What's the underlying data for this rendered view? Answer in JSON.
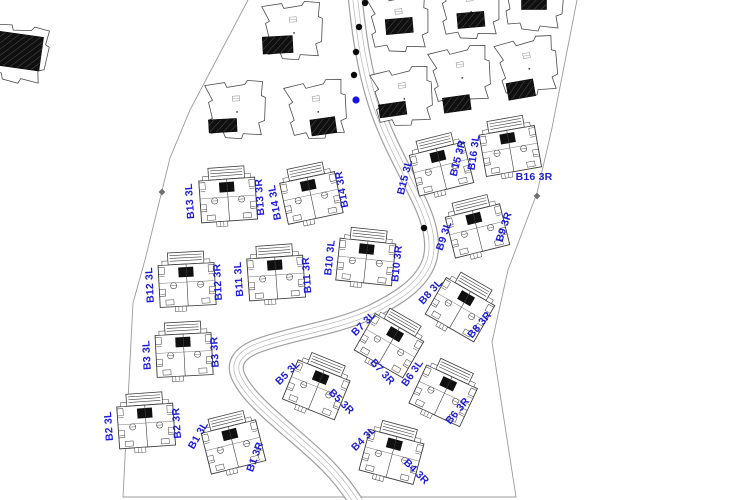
{
  "plan": {
    "title": "residential-site-plan",
    "canvas": {
      "width": 750,
      "height": 500
    },
    "colors": {
      "background": "#ffffff",
      "label_blue": "#1c1cd8",
      "line_dark": "#3d3d3d",
      "line_mid": "#6a6a6a",
      "boundary": "#9a9a9a",
      "road_outer": "#a0a0a0",
      "road_inner": "#b5b5b5",
      "black_fill": "#101010",
      "tree_dot": "#0a0a0a",
      "blue_dot": "#1414e6"
    },
    "boundary": {
      "points": [
        [
          248,
          0
        ],
        [
          190,
          110
        ],
        [
          170,
          158
        ],
        [
          145,
          260
        ],
        [
          133,
          303
        ],
        [
          123,
          497
        ],
        [
          516,
          497
        ],
        [
          492,
          342
        ],
        [
          508,
          270
        ],
        [
          537,
          193
        ],
        [
          552,
          128
        ],
        [
          577,
          0
        ]
      ],
      "markers": [
        [
          162,
          192
        ],
        [
          537,
          196
        ],
        [
          443,
          285
        ]
      ]
    },
    "road": {
      "path": "M 355,-4 C 359,35 364,68 374,100 C 385,136 402,165 417,196 C 428,218 436,242 429,262 C 421,284 399,298 373,311 C 337,328 297,332 263,344 C 241,351 231,362 239,378 C 248,396 267,412 290,432 C 313,452 336,470 356,502",
      "tree_dots": [
        [
          365,
          3
        ],
        [
          359,
          27
        ],
        [
          356,
          52
        ],
        [
          354,
          75
        ],
        [
          424,
          228
        ]
      ],
      "blue_dot": [
        356,
        100
      ]
    },
    "villas": [
      {
        "cx": 18,
        "cy": 54,
        "rot": 8,
        "rect": {
          "dx": 0,
          "dy": -3,
          "w": 46,
          "h": 34
        }
      },
      {
        "cx": 293,
        "cy": 31,
        "rot": -3,
        "rect": {
          "dx": -16,
          "dy": 13,
          "w": 30,
          "h": 17
        }
      },
      {
        "cx": 236,
        "cy": 110,
        "rot": -3,
        "rect": {
          "dx": -14,
          "dy": 15,
          "w": 28,
          "h": 13
        }
      },
      {
        "cx": 317,
        "cy": 110,
        "rot": -8,
        "rect": {
          "dx": 4,
          "dy": 17,
          "w": 25,
          "h": 16
        }
      },
      {
        "cx": 399,
        "cy": 23,
        "rot": -5,
        "rect": {
          "dx": 0,
          "dy": 3,
          "w": 27,
          "h": 15
        }
      },
      {
        "cx": 403,
        "cy": 97,
        "rot": -8,
        "rect": {
          "dx": -12,
          "dy": 11,
          "w": 27,
          "h": 13
        }
      },
      {
        "cx": 470,
        "cy": 10,
        "rot": -5,
        "rect": {
          "dx": 0,
          "dy": 10,
          "w": 27,
          "h": 15
        }
      },
      {
        "cx": 534,
        "cy": 2,
        "rot": 0,
        "rect": {
          "dx": 0,
          "dy": 1,
          "w": 25,
          "h": 13
        }
      },
      {
        "cx": 461,
        "cy": 76,
        "rot": -8,
        "rect": {
          "dx": -8,
          "dy": 27,
          "w": 27,
          "h": 15
        }
      },
      {
        "cx": 528,
        "cy": 67,
        "rot": -10,
        "rect": {
          "dx": -11,
          "dy": 21,
          "w": 27,
          "h": 17
        }
      }
    ],
    "duplexes": [
      {
        "id": "B13",
        "cx": 228,
        "cy": 198,
        "rot": -4,
        "left": {
          "text": "B13 3L",
          "dx": -35,
          "dy": 3,
          "rot": -94
        },
        "right": {
          "text": "B13 3R",
          "dx": 35,
          "dy": -1,
          "rot": -94
        }
      },
      {
        "id": "B14",
        "cx": 311,
        "cy": 196,
        "rot": -12,
        "left": {
          "text": "B14 3L",
          "dx": -33,
          "dy": 6,
          "rot": -100
        },
        "right": {
          "text": "B14 3R",
          "dx": 34,
          "dy": -7,
          "rot": -100
        }
      },
      {
        "id": "B15",
        "cx": 441,
        "cy": 167,
        "rot": -14,
        "left": {
          "text": "B15 3L",
          "dx": -33,
          "dy": 11,
          "rot": -76
        },
        "right": {
          "text": "B15 3R",
          "dx": 20,
          "dy": -8,
          "rot": -76
        }
      },
      {
        "id": "B16",
        "cx": 510,
        "cy": 149,
        "rot": -10,
        "left": {
          "text": "B16 3L",
          "dx": -33,
          "dy": 4,
          "rot": -82
        },
        "right": {
          "text": "B16 3R",
          "dx": 24,
          "dy": 31,
          "rot": 0
        }
      },
      {
        "id": "B9",
        "cx": 477,
        "cy": 229,
        "rot": -14,
        "left": {
          "text": "B9 3L",
          "dx": -30,
          "dy": 8,
          "rot": -72
        },
        "right": {
          "text": "B9 3R",
          "dx": 30,
          "dy": -1,
          "rot": -72
        }
      },
      {
        "id": "B12",
        "cx": 187,
        "cy": 283,
        "rot": -3,
        "left": {
          "text": "B12 3L",
          "dx": -34,
          "dy": 2,
          "rot": -93
        },
        "right": {
          "text": "B12 3R",
          "dx": 34,
          "dy": -1,
          "rot": -93
        }
      },
      {
        "id": "B11",
        "cx": 276,
        "cy": 276,
        "rot": -4,
        "left": {
          "text": "B11 3L",
          "dx": -34,
          "dy": 3,
          "rot": -94
        },
        "right": {
          "text": "B11 3R",
          "dx": 34,
          "dy": -1,
          "rot": -94
        }
      },
      {
        "id": "B10",
        "cx": 366,
        "cy": 260,
        "rot": 6,
        "left": {
          "text": "B10 3L",
          "dx": -33,
          "dy": -2,
          "rot": -84
        },
        "right": {
          "text": "B10 3R",
          "dx": 34,
          "dy": 4,
          "rot": -84
        }
      },
      {
        "id": "B3",
        "cx": 184,
        "cy": 353,
        "rot": -3,
        "left": {
          "text": "B3 3L",
          "dx": -34,
          "dy": 2,
          "rot": -93
        },
        "right": {
          "text": "B3 3R",
          "dx": 34,
          "dy": -1,
          "rot": -93
        }
      },
      {
        "id": "B2",
        "cx": 146,
        "cy": 424,
        "rot": -4,
        "left": {
          "text": "B2 3L",
          "dx": -34,
          "dy": 2,
          "rot": -94
        },
        "right": {
          "text": "B2 3R",
          "dx": 34,
          "dy": -1,
          "rot": -94
        }
      },
      {
        "id": "B1",
        "cx": 233,
        "cy": 445,
        "rot": -14,
        "left": {
          "text": "B1 3L",
          "dx": -32,
          "dy": -8,
          "rot": -60
        },
        "right": {
          "text": "B1 3R",
          "dx": 25,
          "dy": 13,
          "rot": -70
        }
      },
      {
        "id": "B5",
        "cx": 317,
        "cy": 388,
        "rot": 22,
        "left": {
          "text": "B5 3L",
          "dx": -27,
          "dy": -13,
          "rot": -45
        },
        "right": {
          "text": "B5 3R",
          "dx": 22,
          "dy": 16,
          "rot": 45
        }
      },
      {
        "id": "B4",
        "cx": 392,
        "cy": 455,
        "rot": 15,
        "left": {
          "text": "B4 3L",
          "dx": -26,
          "dy": -14,
          "rot": -45
        },
        "right": {
          "text": "B4 3R",
          "dx": 22,
          "dy": 19,
          "rot": 45
        }
      },
      {
        "id": "B7",
        "cx": 390,
        "cy": 344,
        "rot": 30,
        "left": {
          "text": "B7 3L",
          "dx": -24,
          "dy": -18,
          "rot": -45
        },
        "right": {
          "text": "B7 3R",
          "dx": -10,
          "dy": 30,
          "rot": 48
        }
      },
      {
        "id": "B8",
        "cx": 461,
        "cy": 308,
        "rot": 30,
        "left": {
          "text": "B8 3L",
          "dx": -28,
          "dy": -14,
          "rot": -48
        },
        "right": {
          "text": "B8 3R",
          "dx": 21,
          "dy": 19,
          "rot": -50
        }
      },
      {
        "id": "B6",
        "cx": 444,
        "cy": 394,
        "rot": 25,
        "left": {
          "text": "B6 3L",
          "dx": -29,
          "dy": -19,
          "rot": -55
        },
        "right": {
          "text": "B6 3R",
          "dx": 16,
          "dy": 19,
          "rot": -50
        }
      }
    ]
  }
}
